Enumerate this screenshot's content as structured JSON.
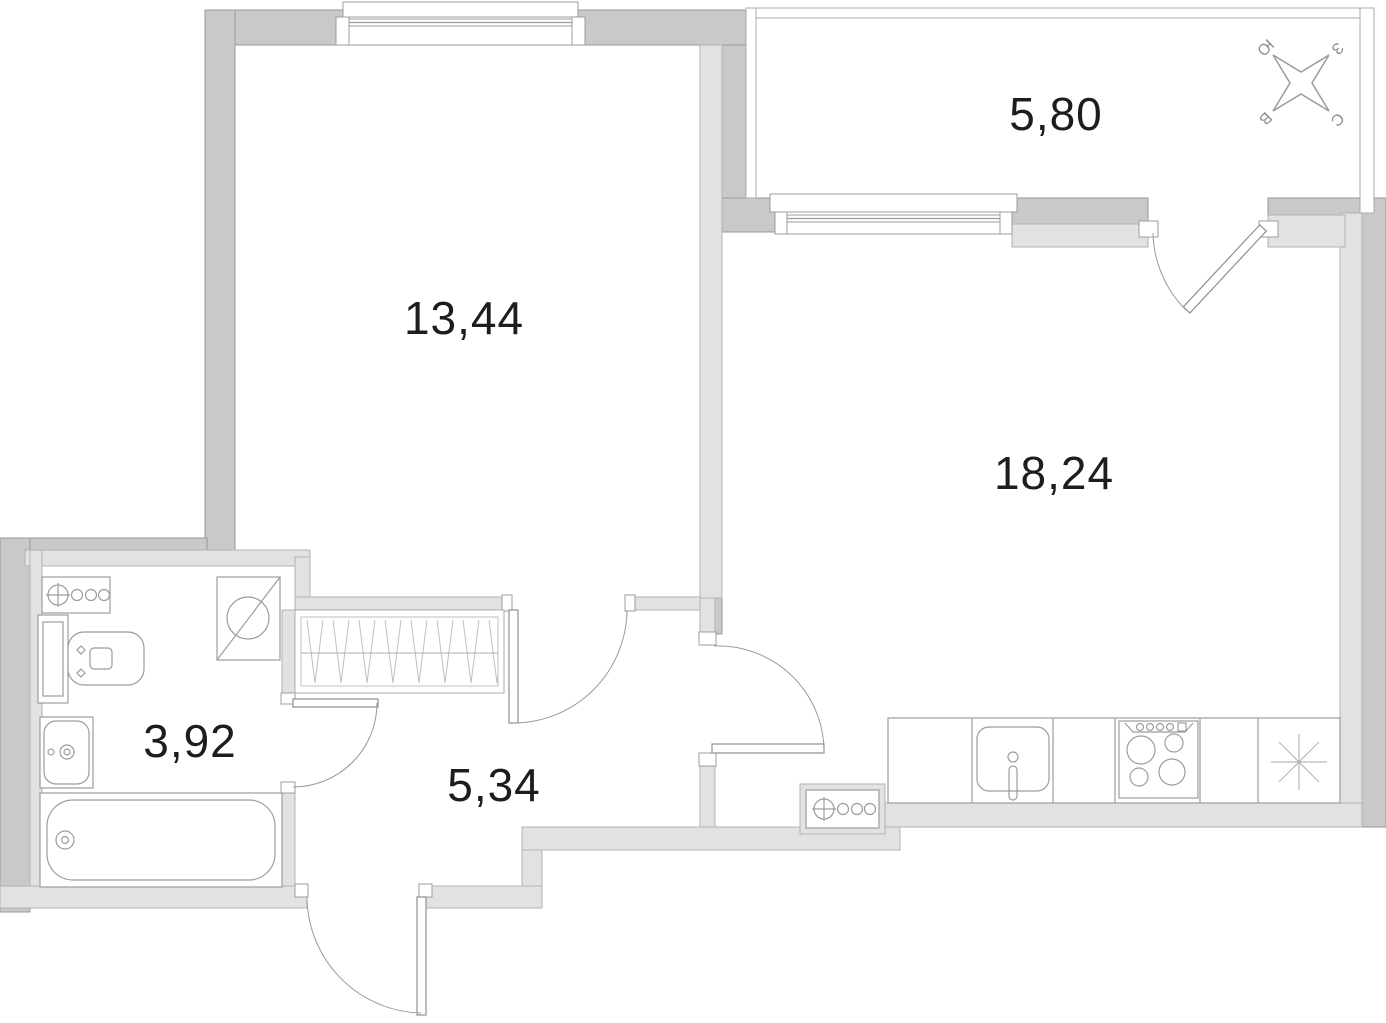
{
  "plan": {
    "rooms": [
      {
        "id": "bedroom",
        "area_label": "13,44"
      },
      {
        "id": "balcony",
        "area_label": "5,80"
      },
      {
        "id": "living-kitchen",
        "area_label": "18,24"
      },
      {
        "id": "bathroom",
        "area_label": "3,92"
      },
      {
        "id": "hallway",
        "area_label": "5,34"
      }
    ],
    "compass": {
      "south": "Ю",
      "west": "З",
      "east": "В",
      "north": "С"
    },
    "colors": {
      "wall_dark": "#c9c9c9",
      "wall_light": "#e2e2e2",
      "outline_dark": "#999999",
      "outline_light": "#b3b3b3",
      "line": "#9c9c9c",
      "text": "#1d1d1d",
      "bg": "#ffffff"
    }
  }
}
